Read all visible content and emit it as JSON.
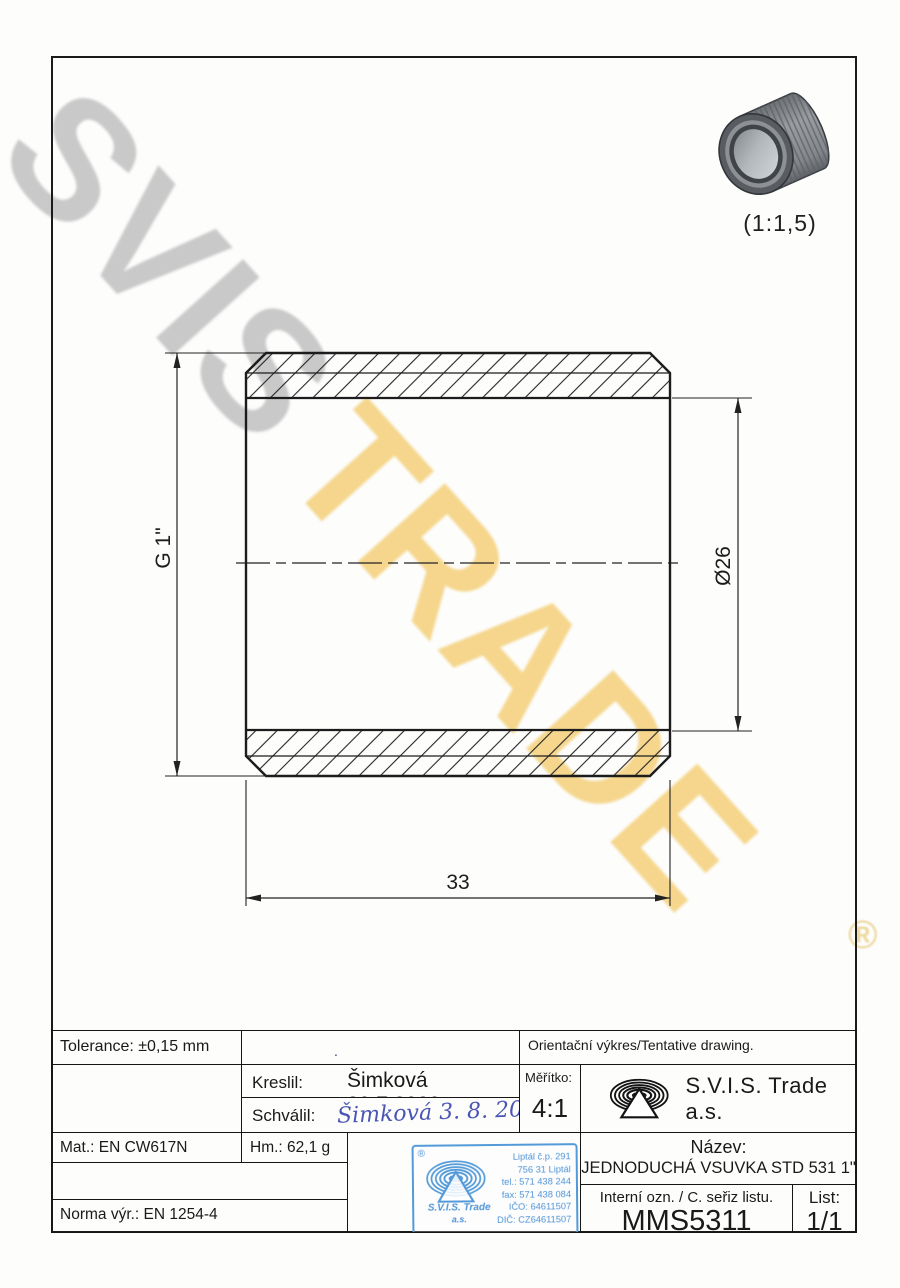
{
  "watermark": {
    "word1": "SVIS",
    "word2": "TRADE",
    "registered": "®"
  },
  "thumbnail": {
    "scale_label": "(1:1,5)"
  },
  "drawing": {
    "dim_height": "G 1\"",
    "dim_bore": "Ø26",
    "dim_length": "33"
  },
  "title_block": {
    "tolerance": "Tolerance: ±0,15 mm",
    "empty_cell_dot": ".",
    "orientation_note": "Orientační výkres/Tentative drawing.",
    "kreslil_label": "Kreslil:",
    "kreslil_value": "Šimková 30.7.2020",
    "schvalil_label": "Schválil:",
    "schvalil_signature": "Šimková 3. 8. 2020",
    "meritko_label": "Měřítko:",
    "meritko_value": "4:1",
    "company": "S.V.I.S. Trade a.s.",
    "mat": "Mat.: EN CW617N",
    "hm": "Hm.: 62,1 g",
    "norma": "Norma výr.: EN 1254-4",
    "nazev_label": "Název:",
    "nazev_value": "JEDNODUCHÁ VSUVKA STD 531 1\"",
    "interni_label": "Interní ozn. / C. seřiz listu.",
    "interni_value": "MMS5311",
    "list_label": "List:",
    "list_value": "1/1"
  },
  "stamp": {
    "registered": "®",
    "company_line1": "S.V.I.S. Trade",
    "company_line2": "a.s.",
    "address_lines": [
      "Liptál č.p. 291",
      "756 31 Liptál",
      "tel.: 571 438 244",
      "fax: 571 438 084",
      "IČO: 64611507",
      "DIČ: CZ64611507"
    ]
  },
  "colors": {
    "line": "#1b1b1b",
    "watermark_gray": "#c9c9c9",
    "watermark_yellow": "#f5d68c",
    "stamp_blue": "#539ad8",
    "signature_ink": "#4a55b4"
  }
}
